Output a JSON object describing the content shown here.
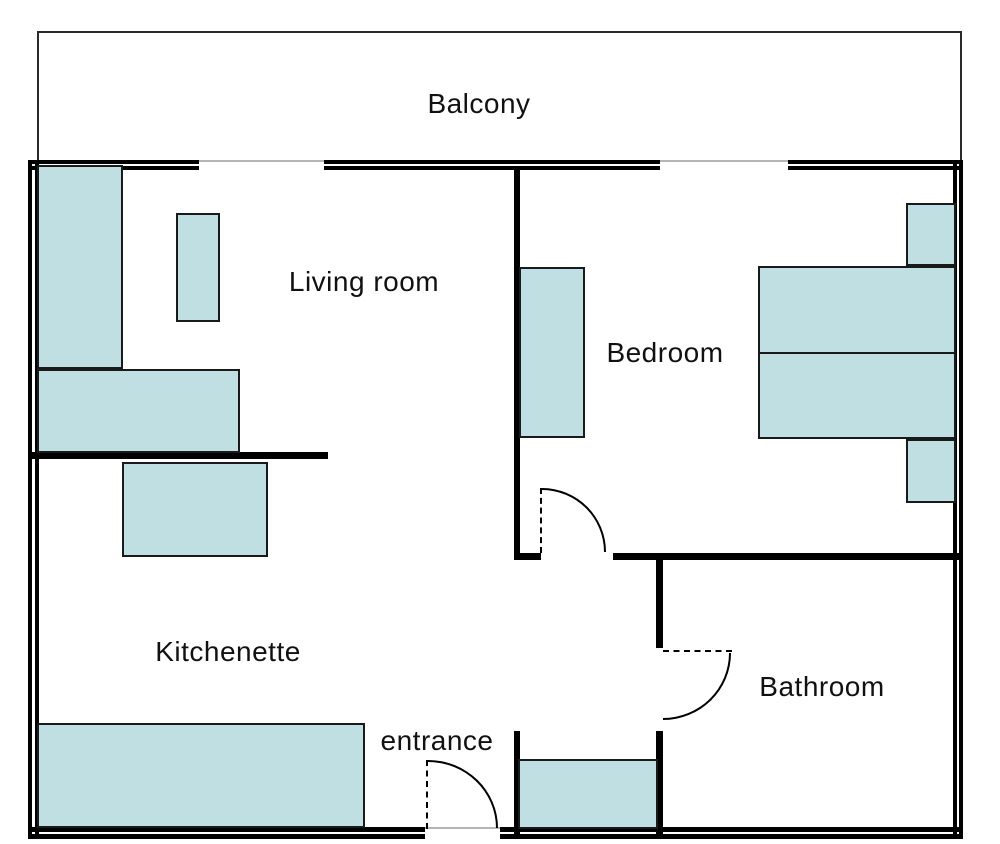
{
  "rooms": {
    "balcony": "Balcony",
    "living_room": "Living room",
    "bedroom": "Bedroom",
    "kitchenette": "Kitchenette",
    "bathroom": "Bathroom",
    "entrance": "entrance"
  },
  "colors": {
    "background": "#ffffff",
    "wall": "#000000",
    "opening_line": "#b5b5b5",
    "furniture_fill": "#bfdfe2",
    "furniture_border": "#1a1a1a",
    "balcony_outline": "#2a2a2a",
    "label_text": "#111111"
  }
}
